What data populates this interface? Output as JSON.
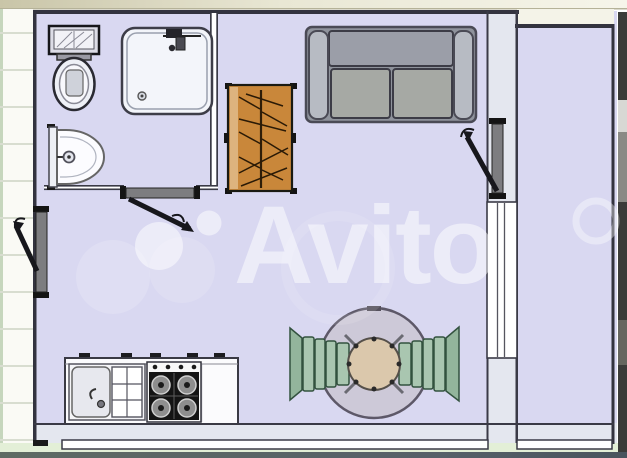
{
  "watermark": {
    "text": "Avito",
    "color": "#ffffff"
  },
  "plan": {
    "type": "apartment-floor-plan",
    "colors": {
      "floor": "#d9d8f1",
      "wall_band": "#e4e7ef",
      "wall_line": "#33333f",
      "wardrobe": "#c9873a",
      "sofa": "#8f939c",
      "sofa_cushion": "#a6a9a4",
      "chair": "#a9c6b0",
      "table_top": "#cdc9d8",
      "table_base": "#dbc8ac",
      "door": "#7d7d80",
      "outside_siding": "#fafaf5",
      "outside_green": "#e3efd7",
      "outside_dark": "#3b3b39"
    },
    "rooms": [
      "bathroom",
      "main-room",
      "balcony"
    ],
    "furniture": [
      "toilet",
      "shower-tray",
      "washbasin",
      "wardrobe",
      "sofa",
      "dining-table",
      "chair-left",
      "chair-right",
      "kitchen-counter",
      "kitchen-sink",
      "gas-stove"
    ],
    "doors": [
      "entrance-door",
      "bathroom-door",
      "balcony-door"
    ],
    "windows": [
      "balcony-wall-window",
      "bottom-window-main",
      "bottom-window-balcony"
    ]
  }
}
